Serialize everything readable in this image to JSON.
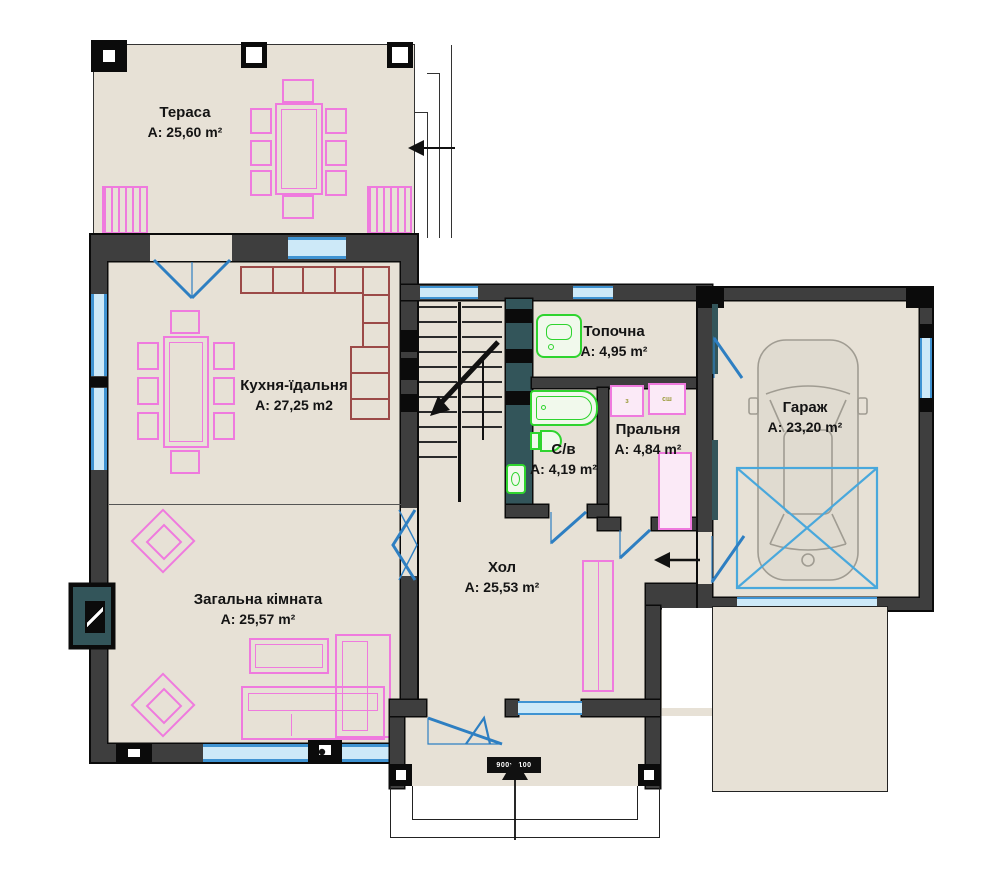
{
  "plan_title": "first-floor-plan",
  "rooms": {
    "terrace": {
      "name": "Тераса",
      "area": "A: 25,60 m²"
    },
    "kitchen": {
      "name": "Кухня-їдальня",
      "area": "A: 27,25 m2"
    },
    "living": {
      "name": "Загальна кімната",
      "area": "A: 25,57 m²"
    },
    "boiler": {
      "name": "Топочна",
      "area": "A: 4,95 m²"
    },
    "bathroom": {
      "name": "С/в",
      "area": "A: 4,19 m²"
    },
    "laundry": {
      "name": "Пральня",
      "area": "A: 4,84 m²"
    },
    "hall": {
      "name": "Хол",
      "area": "A: 25,53 m²"
    },
    "garage": {
      "name": "Гараж",
      "area": "A: 23,20 m²"
    }
  },
  "tags": {
    "washer": "з",
    "dryer": "сш",
    "entry_door": "900х2100"
  },
  "colors": {
    "wall": "#3e3e3e",
    "floor": "#e7e1d6",
    "window_blue": "#3f93d2",
    "furniture_pink": "#ef7ade",
    "fixture_green": "#2fd42f",
    "counter_red": "#9c4a48",
    "teal_accent": "#33555a",
    "car_gray": "#a09c92",
    "garage_marking_blue": "#49a8dc"
  }
}
